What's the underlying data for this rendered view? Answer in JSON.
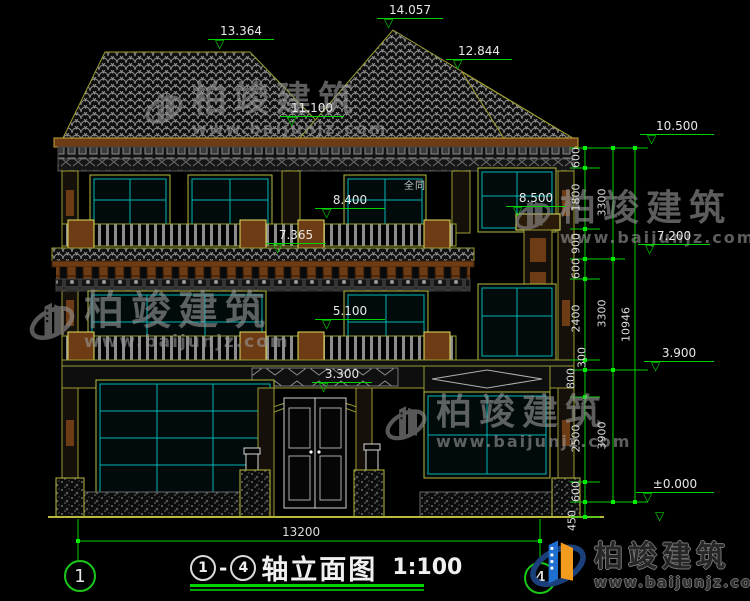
{
  "title": {
    "axis_start": "1",
    "axis_end": "4",
    "dash": "-",
    "name": "轴立面图",
    "scale": "1:100"
  },
  "axes": {
    "left": "1",
    "right": "4"
  },
  "note": "全同",
  "watermark": {
    "brand": "柏竣建筑",
    "url": "www.baijunjz.com"
  },
  "logo": {
    "brand": "柏竣建筑",
    "url": "www.baijunjz.com"
  },
  "elevations": [
    {
      "label": "14.057"
    },
    {
      "label": "13.364"
    },
    {
      "label": "12.844"
    },
    {
      "label": "11.100"
    },
    {
      "label": "8.400"
    },
    {
      "label": "7.365"
    },
    {
      "label": "5.100"
    },
    {
      "label": "3.300"
    },
    {
      "label": "8.500"
    },
    {
      "label": "10.500"
    },
    {
      "label": "7.200"
    },
    {
      "label": "3.900"
    },
    {
      "label": "±0.000"
    }
  ],
  "dimensions": {
    "bottom_width": "13200",
    "right_inner": [
      "600",
      "1800",
      "900",
      "600",
      "2400",
      "300",
      "800",
      "2500",
      "600",
      "450"
    ],
    "right_mid": [
      "3300",
      "3300",
      "3900"
    ],
    "right_total": "10946"
  },
  "colors": {
    "dimension_green": "#00d400",
    "cad_olive": "#9c9c30",
    "glass_cyan": "#00b4b4",
    "eave_brown": "#6e3c14",
    "logo_blue": "#1e6fd0",
    "logo_orange": "#f29b1d"
  }
}
